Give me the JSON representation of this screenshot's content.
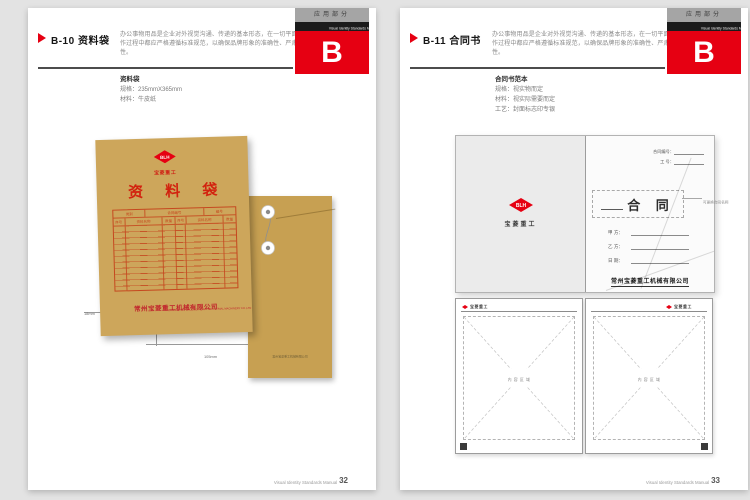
{
  "colors": {
    "accent_red": "#e60012",
    "kraft_front": "#cda65b",
    "kraft_back": "#c7a052",
    "print_red": "#c5481f"
  },
  "chrome": {
    "tab_label": "应用部分",
    "manual_title": "Visual Identity Standards Manual",
    "section_letter": "B",
    "description": "办公事物用品是企业对外视觉沟通、传递的基本形态，在一切平面及立体制作过程中都应严格遵循标准规范，以确保品牌形象的准确性、严肃性及规范性。",
    "footer_text": "Visual Identity Standards Manual"
  },
  "brand": {
    "logo_initials": "BLH",
    "logo_name": "宝菱重工",
    "company_cn": "常州宝菱重工机械有限公司",
    "company_en": "CHANGZHOU BAOLING HEAVY INDUSTRIAL MACHINERY CO.,LTD"
  },
  "left_page": {
    "code_title": "B-10 资料袋",
    "page_number": "32",
    "spec": {
      "title": "资料袋",
      "line1": "规格：235mmX365mm",
      "line2": "材料：牛皮纸"
    },
    "envelope": {
      "title": "资 料 袋",
      "table_top": [
        "类别",
        "合同编号",
        "编号"
      ],
      "table_cols": [
        "序号",
        "资料名称",
        "数量",
        "序号",
        "资料名称",
        "数量"
      ],
      "dim_height": "18mm",
      "dim_width": "105mm"
    }
  },
  "right_page": {
    "code_title": "B-11 合同书",
    "page_number": "33",
    "spec": {
      "title": "合同书范本",
      "line1": "规格：视实物而定",
      "line2": "材料：视实际需要而定",
      "line3": "工艺：封面标志印专银"
    },
    "cover": {
      "contract_no_label": "合同编号：",
      "job_no_label": "工  号：",
      "title": "合  同",
      "annotation": "可更换合同名称",
      "party_a": "甲 方：",
      "party_b": "乙 方：",
      "date_label": "日 期："
    },
    "inner": {
      "header": "宝菱重工",
      "placeholder": "内 容 区 域",
      "left_no": "1",
      "right_no": "2"
    }
  }
}
